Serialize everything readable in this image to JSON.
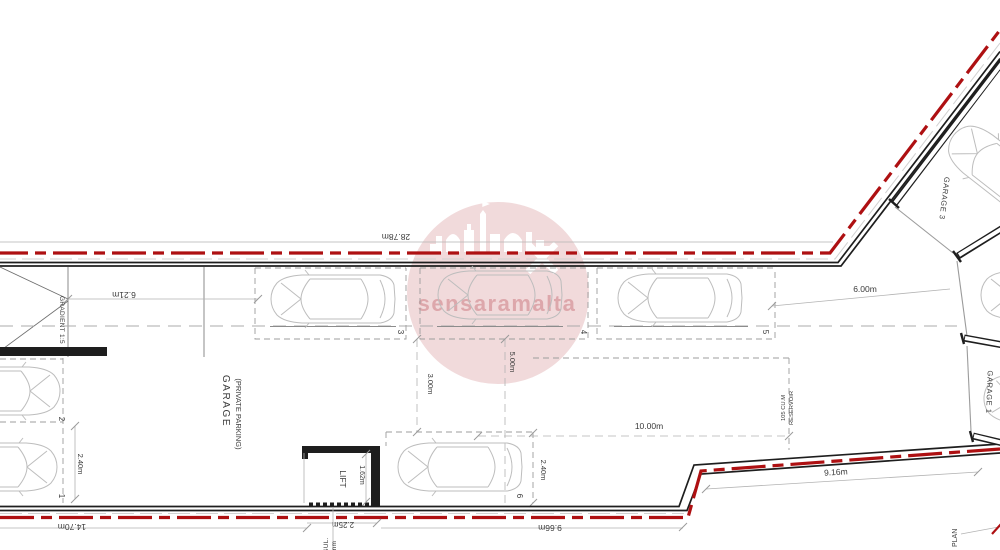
{
  "watermark": {
    "text": "sensaramalta"
  },
  "labels": {
    "dim_top": "28.78m",
    "dim_ramp": "6.21m",
    "dim_3m": "3.00m",
    "dim_5m": "5.00m",
    "dim_6m": "6.00m",
    "dim_10m": "10.00m",
    "dim_916": "9.16m",
    "dim_966": "9.66m",
    "dim_1470": "14.70m",
    "dim_225": "2.25m",
    "dim_162": "1.62m",
    "dim_240_left": "2.40m",
    "dim_240_right": "2.40m",
    "gradient": "GRADIENT 1:5",
    "garage_line1": "GARAGE",
    "garage_line2": "(PRIVATE PARKING)",
    "garage1": "GARAGE 1",
    "garage3": "GARAGE 3",
    "lift": "LIFT",
    "plan": "PLAN",
    "reservoir1": "RESERVOIR",
    "reservoir2": "105 CU.M",
    "insul1": "50mm",
    "insul2": "INSUL."
  },
  "spaces": {
    "n1": "1",
    "n2": "2",
    "n3": "3",
    "n4": "4",
    "n5": "5",
    "n6": "6"
  },
  "colors": {
    "boundary_red": "#ae1012",
    "wall_black": "#1e1e1e",
    "dim_gray": "#b3b3b3",
    "car_gray": "#bdbdbd",
    "text_dark": "#3a3a3a",
    "watermark_circle": "#f1dadb",
    "watermark_text": "#dda7ab"
  }
}
